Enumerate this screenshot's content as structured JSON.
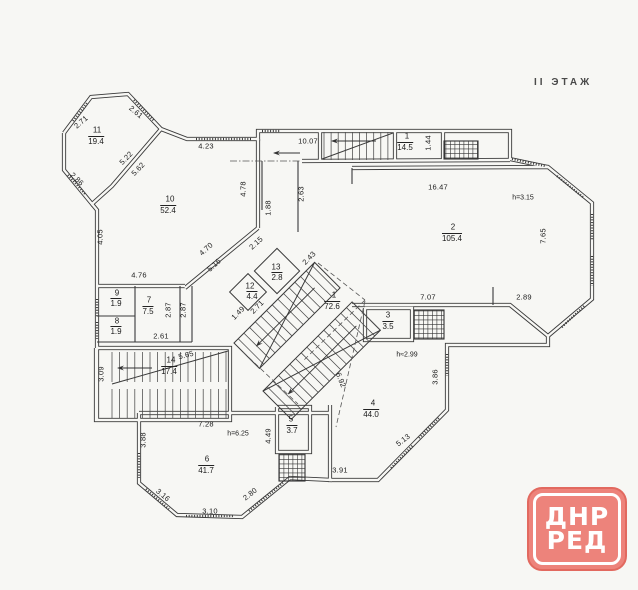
{
  "title": {
    "floor_label": "II ЭТАЖ"
  },
  "logo": {
    "line1": "ДНР",
    "line2": "РЕД",
    "bg": "#ed837b",
    "text_color": "#ffffff"
  },
  "colors": {
    "paper": "#f7f7f4",
    "ink": "#3a3a3a",
    "logo_bg": "#ed837b"
  },
  "plan": {
    "rooms": [
      {
        "number": "1",
        "area": "72.6"
      },
      {
        "number": "2",
        "area": "105.4"
      },
      {
        "number": "3",
        "area": "3.5"
      },
      {
        "number": "4",
        "area": "44.0"
      },
      {
        "number": "5",
        "area": "3.7"
      },
      {
        "number": "6",
        "area": "41.7"
      },
      {
        "number": "7",
        "area": "7.5"
      },
      {
        "number": "8",
        "area": "1.9"
      },
      {
        "number": "9",
        "area": "1.9"
      },
      {
        "number": "10",
        "area": "52.4"
      },
      {
        "number": "11",
        "area": "19.4"
      },
      {
        "number": "12",
        "area": "4.4"
      },
      {
        "number": "13",
        "area": "2.8"
      },
      {
        "number": "14",
        "area": "17.4"
      },
      {
        "number": "1",
        "area": "14.5"
      }
    ],
    "height_notes": [
      "h=3.15",
      "h=6.25",
      "h≈2.99"
    ],
    "labels": [
      {
        "t": "11",
        "x": 97,
        "y": 130,
        "c": "num"
      },
      {
        "t": "19.4",
        "x": 96,
        "y": 141,
        "c": "area"
      },
      {
        "t": "10",
        "x": 170,
        "y": 199,
        "c": "num"
      },
      {
        "t": "52.4",
        "x": 168,
        "y": 210,
        "c": "area"
      },
      {
        "t": "1",
        "x": 334,
        "y": 295,
        "c": "num"
      },
      {
        "t": "72.6",
        "x": 332,
        "y": 306,
        "c": "area"
      },
      {
        "t": "2",
        "x": 453,
        "y": 227,
        "c": "num"
      },
      {
        "t": "105.4",
        "x": 452,
        "y": 238,
        "c": "area"
      },
      {
        "t": "3",
        "x": 388,
        "y": 315,
        "c": "num"
      },
      {
        "t": "3.5",
        "x": 388,
        "y": 326,
        "c": "area"
      },
      {
        "t": "4",
        "x": 373,
        "y": 403,
        "c": "num"
      },
      {
        "t": "44.0",
        "x": 371,
        "y": 414,
        "c": "area"
      },
      {
        "t": "5",
        "x": 291,
        "y": 419,
        "c": "num"
      },
      {
        "t": "3.7",
        "x": 292,
        "y": 430,
        "c": "area"
      },
      {
        "t": "6",
        "x": 207,
        "y": 459,
        "c": "num"
      },
      {
        "t": "41.7",
        "x": 206,
        "y": 470,
        "c": "area"
      },
      {
        "t": "7",
        "x": 149,
        "y": 300,
        "c": "num"
      },
      {
        "t": "7.5",
        "x": 148,
        "y": 311,
        "c": "area"
      },
      {
        "t": "8",
        "x": 117,
        "y": 321,
        "c": "num"
      },
      {
        "t": "1.9",
        "x": 116,
        "y": 331,
        "c": "area"
      },
      {
        "t": "9",
        "x": 117,
        "y": 293,
        "c": "num"
      },
      {
        "t": "1.9",
        "x": 116,
        "y": 303,
        "c": "area"
      },
      {
        "t": "12",
        "x": 250,
        "y": 286,
        "c": "num"
      },
      {
        "t": "4.4",
        "x": 252,
        "y": 296,
        "c": "area"
      },
      {
        "t": "13",
        "x": 276,
        "y": 267,
        "c": "num"
      },
      {
        "t": "2.8",
        "x": 277,
        "y": 277,
        "c": "area"
      },
      {
        "t": "14",
        "x": 171,
        "y": 360,
        "c": "num"
      },
      {
        "t": "17.4",
        "x": 169,
        "y": 371,
        "c": "area"
      },
      {
        "t": "1",
        "x": 407,
        "y": 136,
        "c": "num"
      },
      {
        "t": "14.5",
        "x": 405,
        "y": 147,
        "c": "area"
      },
      {
        "t": "2.71",
        "x": 81,
        "y": 122,
        "r": -40,
        "c": "dim"
      },
      {
        "t": "2.61",
        "x": 136,
        "y": 112,
        "r": 40,
        "c": "dim"
      },
      {
        "t": "2.86",
        "x": 77,
        "y": 179,
        "r": 44,
        "c": "dim"
      },
      {
        "t": "5.22",
        "x": 126,
        "y": 158,
        "r": -46,
        "c": "dim"
      },
      {
        "t": "5.62",
        "x": 138,
        "y": 169,
        "r": -46,
        "c": "dim"
      },
      {
        "t": "4.05",
        "x": 100,
        "y": 237,
        "r": -90,
        "c": "dim"
      },
      {
        "t": "4.23",
        "x": 206,
        "y": 146,
        "c": "dim"
      },
      {
        "t": "10.07",
        "x": 308,
        "y": 141,
        "c": "dim"
      },
      {
        "t": "4.78",
        "x": 243,
        "y": 189,
        "r": -90,
        "c": "dim"
      },
      {
        "t": "4.76",
        "x": 139,
        "y": 275,
        "c": "dim"
      },
      {
        "t": "4.70",
        "x": 206,
        "y": 249,
        "r": -42,
        "c": "dim"
      },
      {
        "t": "5.16",
        "x": 214,
        "y": 265,
        "r": -42,
        "c": "dim"
      },
      {
        "t": "2.15",
        "x": 256,
        "y": 243,
        "r": -42,
        "c": "dim"
      },
      {
        "t": "1.88",
        "x": 268,
        "y": 208,
        "r": -90,
        "c": "dim"
      },
      {
        "t": "2.63",
        "x": 301,
        "y": 194,
        "r": -90,
        "c": "dim"
      },
      {
        "t": "16.47",
        "x": 438,
        "y": 187,
        "c": "dim"
      },
      {
        "t": "h=3.15",
        "x": 523,
        "y": 198,
        "c": "note"
      },
      {
        "t": "7.65",
        "x": 543,
        "y": 236,
        "r": -90,
        "c": "dim"
      },
      {
        "t": "2.89",
        "x": 524,
        "y": 297,
        "c": "dim"
      },
      {
        "t": "7.07",
        "x": 428,
        "y": 297,
        "c": "dim"
      },
      {
        "t": "1.44",
        "x": 428,
        "y": 143,
        "r": -90,
        "c": "dim"
      },
      {
        "t": "2.43",
        "x": 309,
        "y": 258,
        "r": -45,
        "c": "dim"
      },
      {
        "t": "2.71",
        "x": 257,
        "y": 307,
        "r": -45,
        "c": "dim"
      },
      {
        "t": "1.49",
        "x": 238,
        "y": 313,
        "r": -45,
        "c": "dim"
      },
      {
        "t": "2.87",
        "x": 168,
        "y": 310,
        "r": -90,
        "c": "dim"
      },
      {
        "t": "2.87",
        "x": 183,
        "y": 310,
        "r": -90,
        "c": "dim"
      },
      {
        "t": "2.61",
        "x": 161,
        "y": 336,
        "c": "dim"
      },
      {
        "t": "3.09",
        "x": 101,
        "y": 374,
        "r": -90,
        "c": "dim"
      },
      {
        "t": "5.65",
        "x": 186,
        "y": 355,
        "r": -14,
        "c": "dim"
      },
      {
        "t": "3.88",
        "x": 143,
        "y": 440,
        "r": -90,
        "c": "dim"
      },
      {
        "t": "7.28",
        "x": 206,
        "y": 424,
        "c": "dim"
      },
      {
        "t": "h=6.25",
        "x": 238,
        "y": 434,
        "c": "note"
      },
      {
        "t": "4.49",
        "x": 268,
        "y": 436,
        "r": -90,
        "c": "dim"
      },
      {
        "t": "3.16",
        "x": 163,
        "y": 495,
        "r": 40,
        "c": "dim"
      },
      {
        "t": "3.10",
        "x": 210,
        "y": 511,
        "c": "dim"
      },
      {
        "t": "2.80",
        "x": 250,
        "y": 494,
        "r": -38,
        "c": "dim"
      },
      {
        "t": "3.91",
        "x": 340,
        "y": 470,
        "c": "dim"
      },
      {
        "t": "5.13",
        "x": 403,
        "y": 440,
        "r": -37,
        "c": "dim"
      },
      {
        "t": "3.86",
        "x": 435,
        "y": 377,
        "r": -90,
        "c": "dim"
      },
      {
        "t": "6.92",
        "x": 341,
        "y": 380,
        "r": 68,
        "c": "dim"
      },
      {
        "t": "h≈2.99",
        "x": 407,
        "y": 355,
        "c": "note"
      }
    ]
  }
}
